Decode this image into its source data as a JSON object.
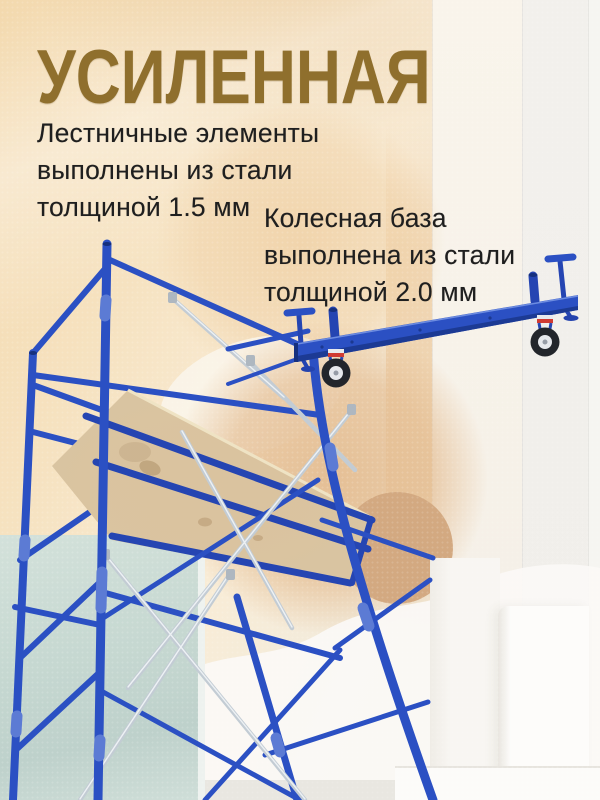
{
  "headline": {
    "text": "УСИЛЕННАЯ"
  },
  "features": [
    {
      "name": "ladder-elements",
      "lines": [
        "Лестничные элементы",
        "выполнены из стали",
        "толщиной 1.5 мм"
      ]
    },
    {
      "name": "wheel-base",
      "lines": [
        "Колесная база",
        "выполнена из стали",
        "толщиной 2.0 мм"
      ]
    }
  ],
  "illustration": {
    "scaffold": "scaffold-tower-with-plywood-deck",
    "wheelbase": "wheel-base-beam-with-casters"
  },
  "colors": {
    "gold": "#8f6f2d",
    "ink": "#1f1f1f",
    "blue": "#2b50c3",
    "blueDark": "#1c3a94",
    "blueMid": "#2545b2",
    "blueLight": "#6d8ce0",
    "silver": "#c3ccd4",
    "silverLight": "#edf1f4",
    "plywood": "#dcc7a4",
    "plywoodDark": "#c2aa83",
    "tan": "#d3a981",
    "peach": "#f0d2a8",
    "teal": "#c9dad3",
    "red": "#d03a32",
    "wheelTire": "#22252b",
    "wheelHub": "#e6e8ec"
  }
}
